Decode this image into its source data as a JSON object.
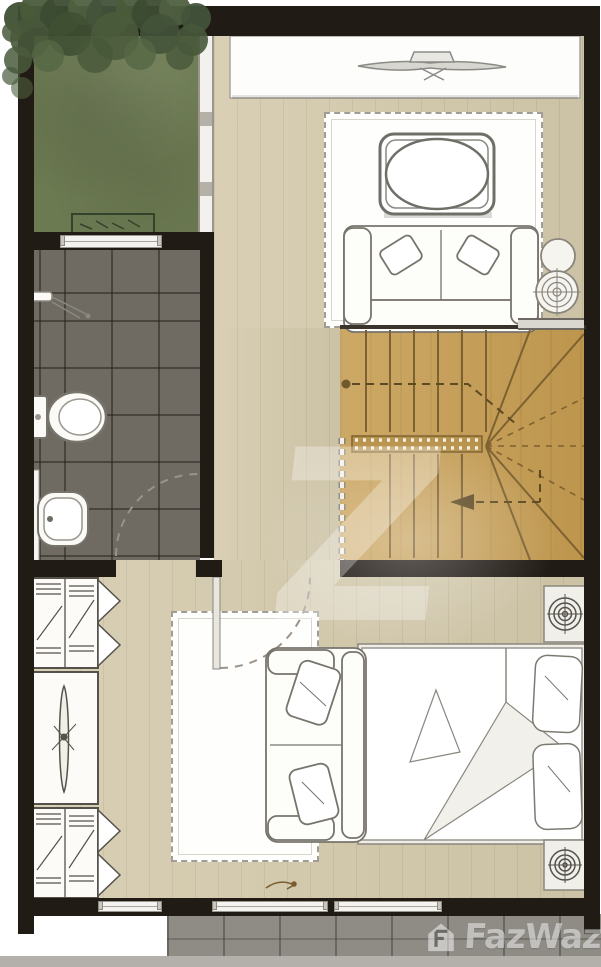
{
  "watermark": {
    "brand": "FazWaz",
    "letter": "Z",
    "logo_icon": "house-icon"
  },
  "palette": {
    "wall": "#211b15",
    "wood_floor": "#d4caac",
    "stair_wood": "#c79f55",
    "bathroom_tile": "#6f6a62",
    "terrace_tile": "#8f8c86",
    "garden_lawn": "#6c7a52",
    "foliage": "#44543a",
    "furniture_line": "#77746c",
    "furniture_fill": "#fdfdfa"
  }
}
